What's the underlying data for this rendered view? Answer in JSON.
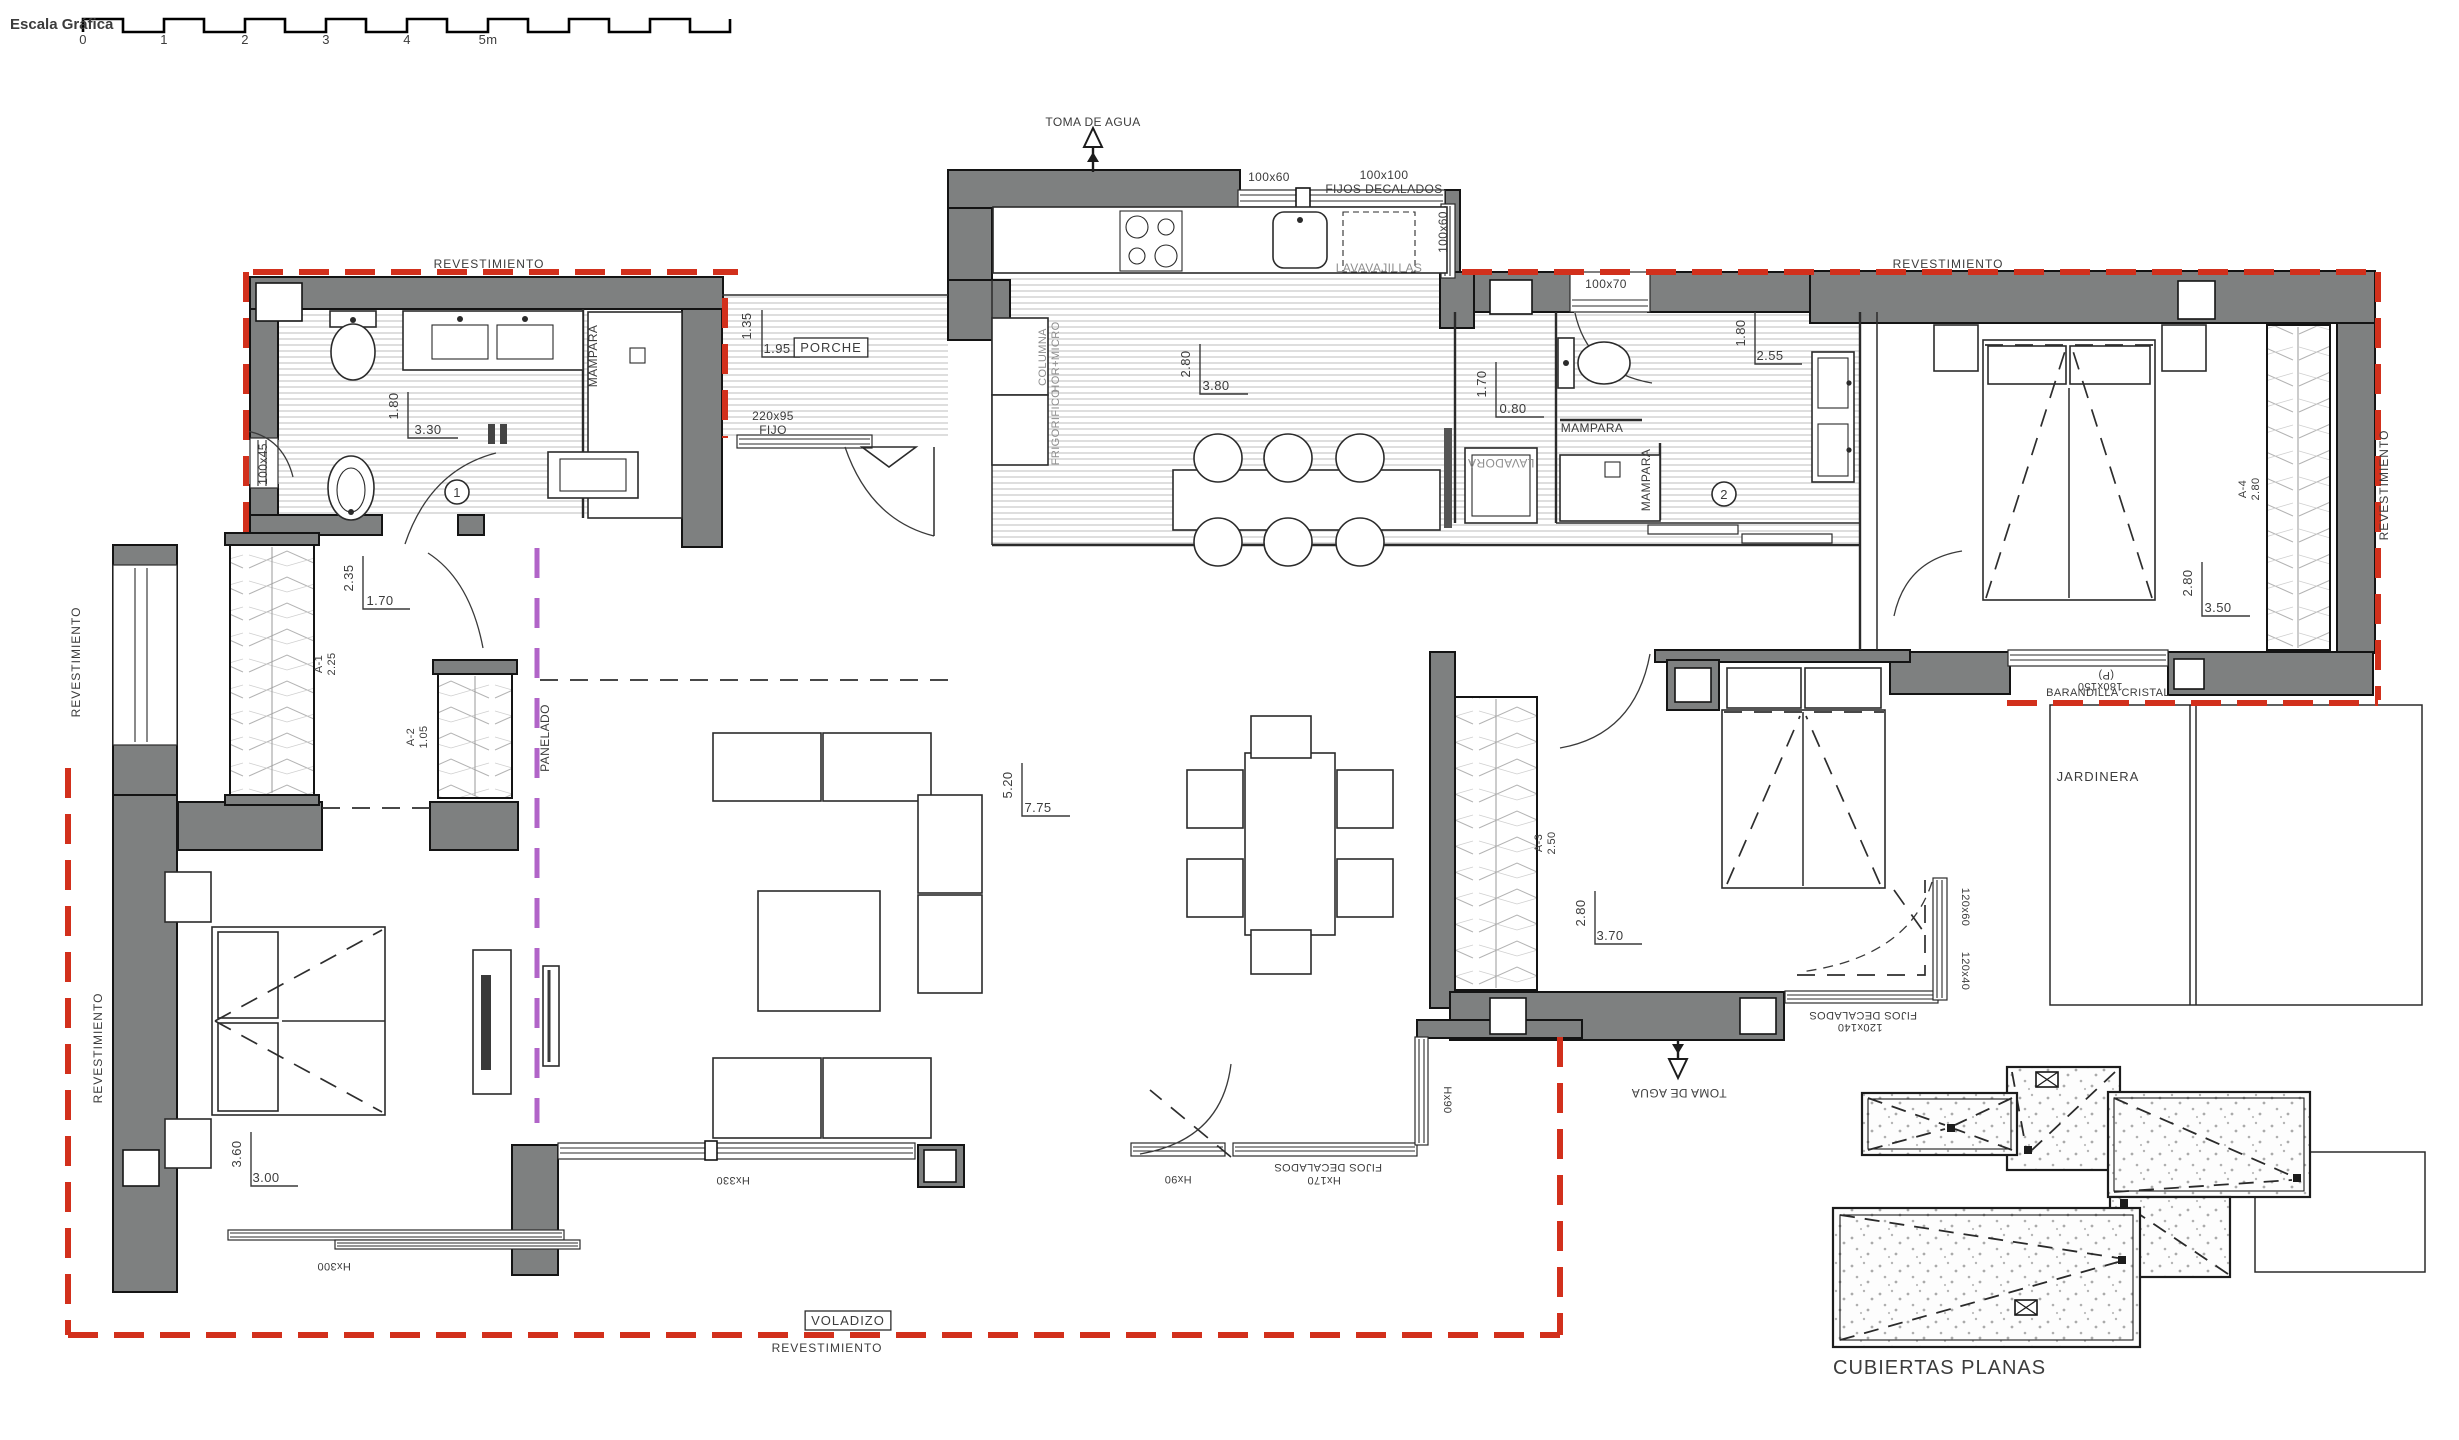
{
  "colors": {
    "wall": "#7e8080",
    "outline": "#141414",
    "red_dashed": "#d2301c",
    "purple_dashed": "#b164c8",
    "hatch": "#b9b9b9",
    "text": "#3c3c3c",
    "muted_text": "#8f8f8f"
  },
  "scale_bar": {
    "label": "Escala Gráfica",
    "ticks": [
      "0",
      "1",
      "2",
      "3",
      "4",
      "5m"
    ]
  },
  "circled_numbers": [
    {
      "value": "1",
      "x": 457,
      "y": 492
    },
    {
      "value": "2",
      "x": 1724,
      "y": 494
    }
  ],
  "labels": [
    {
      "name": "rev-top-left",
      "text": "REVESTIMIENTO",
      "x": 489,
      "y": 268,
      "s": 12,
      "ls": 1
    },
    {
      "name": "rev-top-right",
      "text": "REVESTIMIENTO",
      "x": 1948,
      "y": 268,
      "s": 12,
      "ls": 1
    },
    {
      "name": "rev-right",
      "text": "REVESTIMIENTO",
      "x": 2388,
      "y": 485,
      "r": -90,
      "s": 12,
      "ls": 1
    },
    {
      "name": "rev-left-upper",
      "text": "REVESTIMIENTO",
      "x": 80,
      "y": 662,
      "r": -90,
      "s": 12,
      "ls": 1
    },
    {
      "name": "rev-left-lower",
      "text": "REVESTIMIENTO",
      "x": 102,
      "y": 1048,
      "r": -90,
      "s": 12,
      "ls": 1
    },
    {
      "name": "rev-bottom",
      "text": "REVESTIMIENTO",
      "x": 827,
      "y": 1352,
      "s": 12,
      "ls": 1
    },
    {
      "name": "toma-agua-top",
      "text": "TOMA DE AGUA",
      "x": 1093,
      "y": 126,
      "s": 12
    },
    {
      "name": "win-100x60-top",
      "text": "100x60",
      "x": 1269,
      "y": 181,
      "s": 12
    },
    {
      "name": "win-100x100",
      "text": "100x100",
      "x": 1384,
      "y": 179,
      "s": 12
    },
    {
      "name": "fijos-decalados-top",
      "text": "FIJOS DECALADOS",
      "x": 1384,
      "y": 193,
      "s": 12
    },
    {
      "name": "lavavajillas",
      "text": "LAVAVAJILLAS",
      "x": 1379,
      "y": 272,
      "s": 12,
      "muted": true
    },
    {
      "name": "win-100x60-right",
      "text": "100x60",
      "x": 1447,
      "y": 232,
      "r": -90,
      "s": 12
    },
    {
      "name": "columna",
      "text": "COLUMNA",
      "x": 1046,
      "y": 357,
      "r": -90,
      "s": 11,
      "muted": true
    },
    {
      "name": "hor-micro",
      "text": "HOR+MICRO",
      "x": 1059,
      "y": 357,
      "r": -90,
      "s": 11,
      "muted": true
    },
    {
      "name": "frigorifico",
      "text": "FRIGORIFICO",
      "x": 1059,
      "y": 427,
      "r": -90,
      "s": 11,
      "muted": true
    },
    {
      "name": "dim-porche-v",
      "text": "1.35",
      "x": 751,
      "y": 326,
      "r": -90,
      "s": 13
    },
    {
      "name": "dim-porche-h",
      "text": "1.95",
      "x": 777,
      "y": 353,
      "s": 13
    },
    {
      "name": "porche",
      "text": "PORCHE",
      "x": 831,
      "y": 352,
      "s": 13,
      "boxed": true,
      "ls": 1
    },
    {
      "name": "win-220x95",
      "text": "220x95",
      "x": 773,
      "y": 420,
      "s": 12
    },
    {
      "name": "win-fijo",
      "text": "FIJO",
      "x": 773,
      "y": 434,
      "s": 12
    },
    {
      "name": "dim-bath1-v",
      "text": "1.80",
      "x": 398,
      "y": 406,
      "r": -90,
      "s": 13
    },
    {
      "name": "dim-bath1-h",
      "text": "3.30",
      "x": 428,
      "y": 434,
      "s": 13
    },
    {
      "name": "win-100x45",
      "text": "100x45",
      "x": 267,
      "y": 464,
      "r": -90,
      "s": 12
    },
    {
      "name": "mampara-bath1",
      "text": "MAMPARA",
      "x": 597,
      "y": 356,
      "r": -90,
      "s": 12
    },
    {
      "name": "dim-kitchen-v",
      "text": "2.80",
      "x": 1190,
      "y": 364,
      "r": -90,
      "s": 13
    },
    {
      "name": "dim-kitchen-h",
      "text": "3.80",
      "x": 1216,
      "y": 390,
      "s": 13
    },
    {
      "name": "dim-utility-v",
      "text": "1.70",
      "x": 1486,
      "y": 384,
      "r": -90,
      "s": 13
    },
    {
      "name": "dim-utility-h",
      "text": "0.80",
      "x": 1513,
      "y": 413,
      "s": 13
    },
    {
      "name": "lavadora",
      "text": "LAVADORA",
      "x": 1501,
      "y": 459,
      "r": 180,
      "s": 12,
      "muted": true
    },
    {
      "name": "mampara-bath2-h",
      "text": "MAMPARA",
      "x": 1592,
      "y": 432,
      "s": 12
    },
    {
      "name": "mampara-bath2-v",
      "text": "MAMPARA",
      "x": 1650,
      "y": 480,
      "r": -90,
      "s": 12
    },
    {
      "name": "win-100x70",
      "text": "100x70",
      "x": 1606,
      "y": 288,
      "s": 12
    },
    {
      "name": "dim-bath2-v",
      "text": "1.80",
      "x": 1745,
      "y": 333,
      "r": -90,
      "s": 13
    },
    {
      "name": "dim-bath2-h",
      "text": "2.55",
      "x": 1770,
      "y": 360,
      "s": 13
    },
    {
      "name": "a4-code",
      "text": "A-4",
      "x": 2246,
      "y": 489,
      "r": -90,
      "s": 11
    },
    {
      "name": "a4-dim",
      "text": "2.80",
      "x": 2259,
      "y": 489,
      "r": -90,
      "s": 11
    },
    {
      "name": "dim-master-v",
      "text": "2.80",
      "x": 2192,
      "y": 583,
      "r": -90,
      "s": 13
    },
    {
      "name": "dim-master-h",
      "text": "3.50",
      "x": 2218,
      "y": 612,
      "s": 13
    },
    {
      "name": "rail-p",
      "text": "(P)",
      "x": 2106,
      "y": 672,
      "r": 180,
      "s": 11
    },
    {
      "name": "rail-size",
      "text": "180x150",
      "x": 2100,
      "y": 683,
      "r": 180,
      "s": 11
    },
    {
      "name": "barandilla",
      "text": "BARANDILLA CRISTAL",
      "x": 2108,
      "y": 696,
      "s": 11
    },
    {
      "name": "jardinera",
      "text": "JARDINERA",
      "x": 2098,
      "y": 781,
      "s": 13,
      "ls": 1
    },
    {
      "name": "dim-hall-v",
      "text": "2.35",
      "x": 353,
      "y": 578,
      "r": -90,
      "s": 13
    },
    {
      "name": "dim-hall-h",
      "text": "1.70",
      "x": 380,
      "y": 605,
      "s": 13
    },
    {
      "name": "a1-code",
      "text": "A-1",
      "x": 322,
      "y": 664,
      "r": -90,
      "s": 11
    },
    {
      "name": "a1-dim",
      "text": "2.25",
      "x": 335,
      "y": 664,
      "r": -90,
      "s": 11
    },
    {
      "name": "a2-code",
      "text": "A-2",
      "x": 414,
      "y": 737,
      "r": -90,
      "s": 11
    },
    {
      "name": "a2-dim",
      "text": "1.05",
      "x": 427,
      "y": 737,
      "r": -90,
      "s": 11
    },
    {
      "name": "panelado",
      "text": "PANELADO",
      "x": 549,
      "y": 738,
      "r": -90,
      "s": 12
    },
    {
      "name": "dim-living-v",
      "text": "5.20",
      "x": 1012,
      "y": 785,
      "r": -90,
      "s": 13
    },
    {
      "name": "dim-living-h",
      "text": "7.75",
      "x": 1038,
      "y": 812,
      "s": 13
    },
    {
      "name": "dim-bed3-v",
      "text": "3.60",
      "x": 241,
      "y": 1154,
      "r": -90,
      "s": 13
    },
    {
      "name": "dim-bed3-h",
      "text": "3.00",
      "x": 266,
      "y": 1182,
      "s": 13
    },
    {
      "name": "win-hx300",
      "text": "Hx300",
      "x": 334,
      "y": 1263,
      "r": 180,
      "s": 11
    },
    {
      "name": "win-hx330",
      "text": "Hx330",
      "x": 733,
      "y": 1177,
      "r": 180,
      "s": 11
    },
    {
      "name": "voladizo",
      "text": "VOLADIZO",
      "x": 848,
      "y": 1325,
      "s": 13,
      "boxed": true,
      "ls": 1
    },
    {
      "name": "win-hx90-a",
      "text": "Hx90",
      "x": 1178,
      "y": 1176,
      "r": 180,
      "s": 11
    },
    {
      "name": "fijos-decalados-bottom",
      "text": "FIJOS DECALADOS",
      "x": 1328,
      "y": 1164,
      "r": 180,
      "s": 11
    },
    {
      "name": "win-hx170",
      "text": "Hx170",
      "x": 1324,
      "y": 1177,
      "r": 180,
      "s": 11
    },
    {
      "name": "win-hx90-b",
      "text": "Hx90",
      "x": 1444,
      "y": 1100,
      "r": 90,
      "s": 11
    },
    {
      "name": "a3-code",
      "text": "A-3",
      "x": 1542,
      "y": 843,
      "r": -90,
      "s": 11
    },
    {
      "name": "a3-dim",
      "text": "2.50",
      "x": 1555,
      "y": 843,
      "r": -90,
      "s": 11
    },
    {
      "name": "dim-bed2-v",
      "text": "2.80",
      "x": 1585,
      "y": 913,
      "r": -90,
      "s": 13
    },
    {
      "name": "dim-bed2-h",
      "text": "3.70",
      "x": 1610,
      "y": 940,
      "s": 13
    },
    {
      "name": "toma-agua-bottom",
      "text": "TOMA DE AGUA",
      "x": 1679,
      "y": 1089,
      "r": 180,
      "s": 12
    },
    {
      "name": "fijos-decalados-right",
      "text": "FIJOS DECALADOS",
      "x": 1863,
      "y": 1012,
      "r": 180,
      "s": 11
    },
    {
      "name": "win-120x140",
      "text": "120x140",
      "x": 1860,
      "y": 1024,
      "r": 180,
      "s": 11
    },
    {
      "name": "win-120x60",
      "text": "120x60",
      "x": 1962,
      "y": 907,
      "r": 90,
      "s": 11
    },
    {
      "name": "win-120x40",
      "text": "120x40",
      "x": 1962,
      "y": 971,
      "r": 90,
      "s": 11
    },
    {
      "name": "cubiertas-planas",
      "text": "CUBIERTAS PLANAS",
      "x": 1833,
      "y": 1374,
      "s": 20,
      "anchor": "start",
      "ls": 1
    }
  ]
}
